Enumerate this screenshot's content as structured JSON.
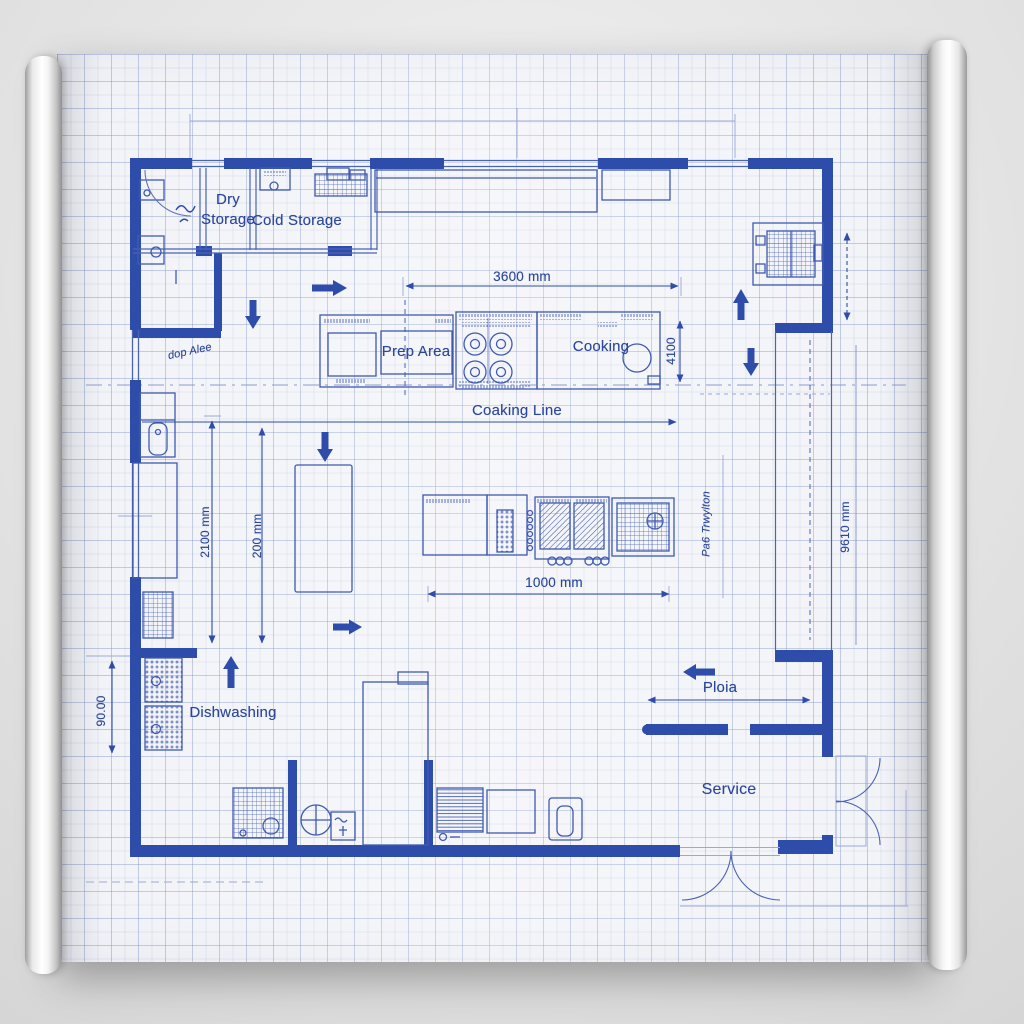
{
  "title": "Commercial Kitchen Floor Plan Blueprint",
  "rooms": {
    "dry_storage": "Dry\nStorage",
    "cold_storage": "Cold Storage",
    "prep_area": "Prep Area",
    "cooking": "Cooking",
    "cooking_line": "Coaking Line",
    "dishwashing": "Dishwashing",
    "service": "Service",
    "plate": "Ploia"
  },
  "annotations": {
    "pass_text": "Pa6 Trwylton",
    "door_note": "dop Alee"
  },
  "dimensions": {
    "top_width": "3600 mm",
    "island_width": "1000 mm",
    "cooking_depth": "4100",
    "left_a": "2100 mm",
    "left_b": "200 mm",
    "right_height": "9610 mm",
    "dish_depth": "90.00"
  },
  "colors": {
    "ink": "#2e4dab",
    "ink_medium": "#3f5ab0",
    "ink_faint": "#9aa8d8",
    "paper": "#f3f4f8",
    "background": "#e3e3e3"
  }
}
